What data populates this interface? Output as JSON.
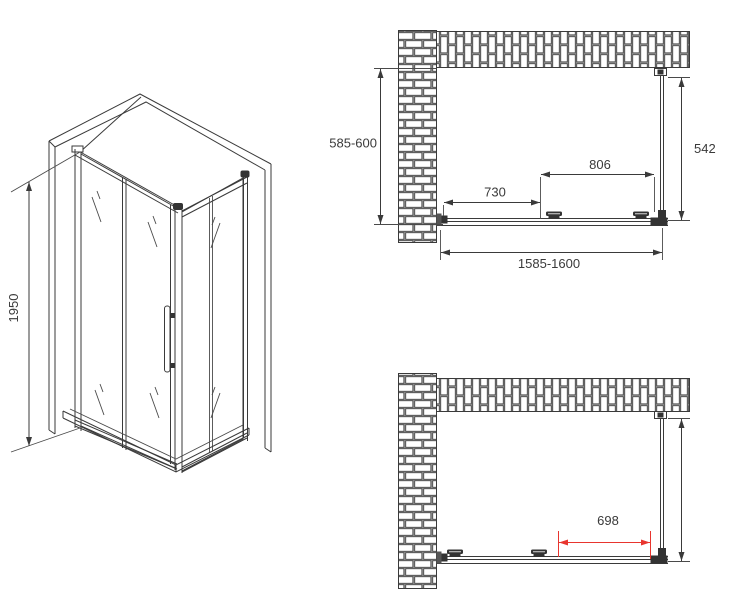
{
  "colors": {
    "line": "#3a3a3a",
    "accent": "#e8352e"
  },
  "iso_view": {
    "height_label": "1950"
  },
  "top_plan": {
    "depth_label": "585-600",
    "side_panel_label": "542",
    "door_span_label": "806",
    "left_span_label": "730",
    "overall_width_label": "1585-1600"
  },
  "bottom_plan": {
    "opening_label": "698"
  }
}
